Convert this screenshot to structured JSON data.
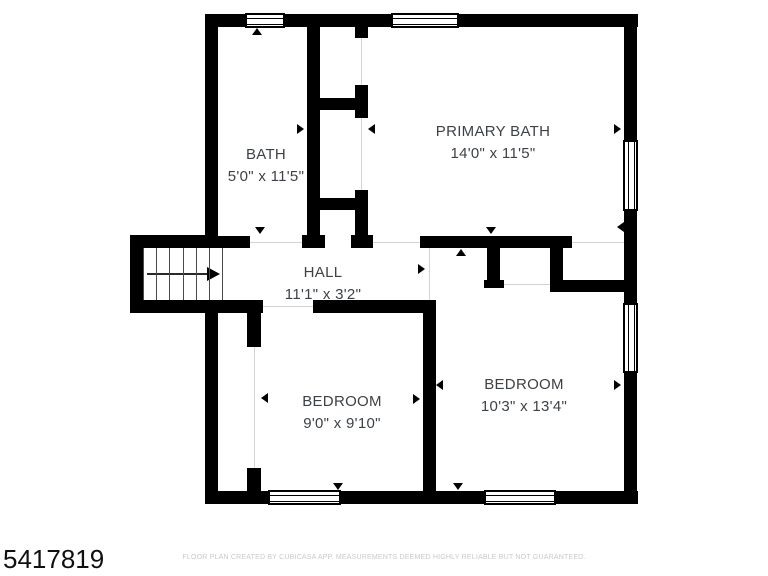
{
  "floor_plan": {
    "rooms": [
      {
        "name": "BATH",
        "dimensions": "5'0\" x 11'5\""
      },
      {
        "name": "PRIMARY BATH",
        "dimensions": "14'0\" x 11'5\""
      },
      {
        "name": "HALL",
        "dimensions": "11'1\" x 3'2\""
      },
      {
        "name": "BEDROOM",
        "dimensions": "9'0\" x 9'10\""
      },
      {
        "name": "BEDROOM",
        "dimensions": "10'3\" x 13'4\""
      }
    ],
    "disclaimer": "FLOOR PLAN CREATED BY CUBICASA APP. MEASUREMENTS DEEMED HIGHLY RELIABLE BUT NOT GUARANTEED.",
    "listing_id": "5417819",
    "colors": {
      "wall": "#000000",
      "room_text": "#3d4247",
      "disclaimer_text": "#c9c9c9",
      "background": "#ffffff"
    }
  }
}
